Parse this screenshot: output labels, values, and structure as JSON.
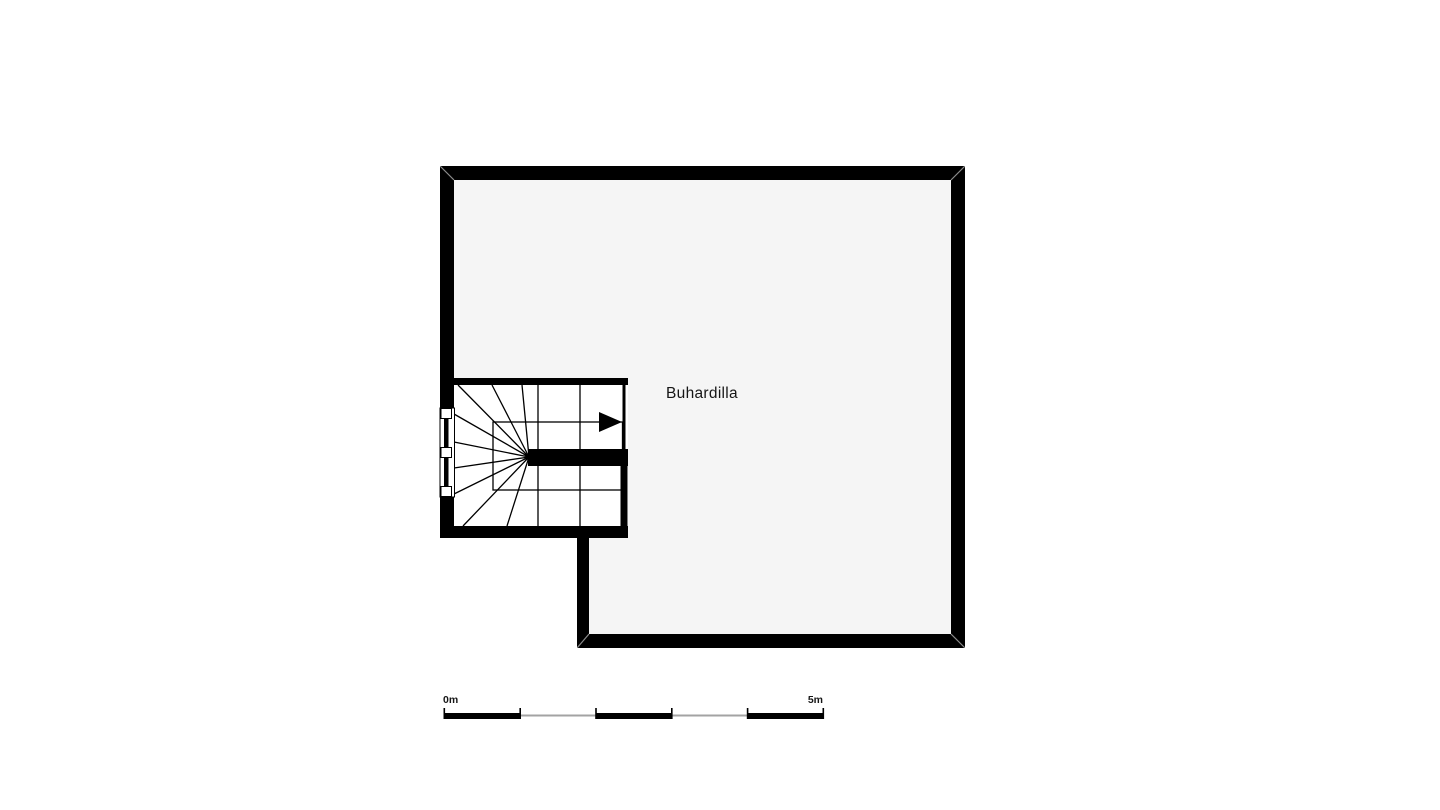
{
  "plan": {
    "room_label": "Buhardilla",
    "colors": {
      "wall": "#000000",
      "floor": "#f5f5f5",
      "stair": "#ffffff",
      "window_frame": "#ffffff",
      "scale_gray": "#a3a3a3",
      "text": "#161616",
      "background": "#ffffff"
    }
  },
  "scale_bar": {
    "start_label": "0m",
    "end_label": "5m"
  }
}
